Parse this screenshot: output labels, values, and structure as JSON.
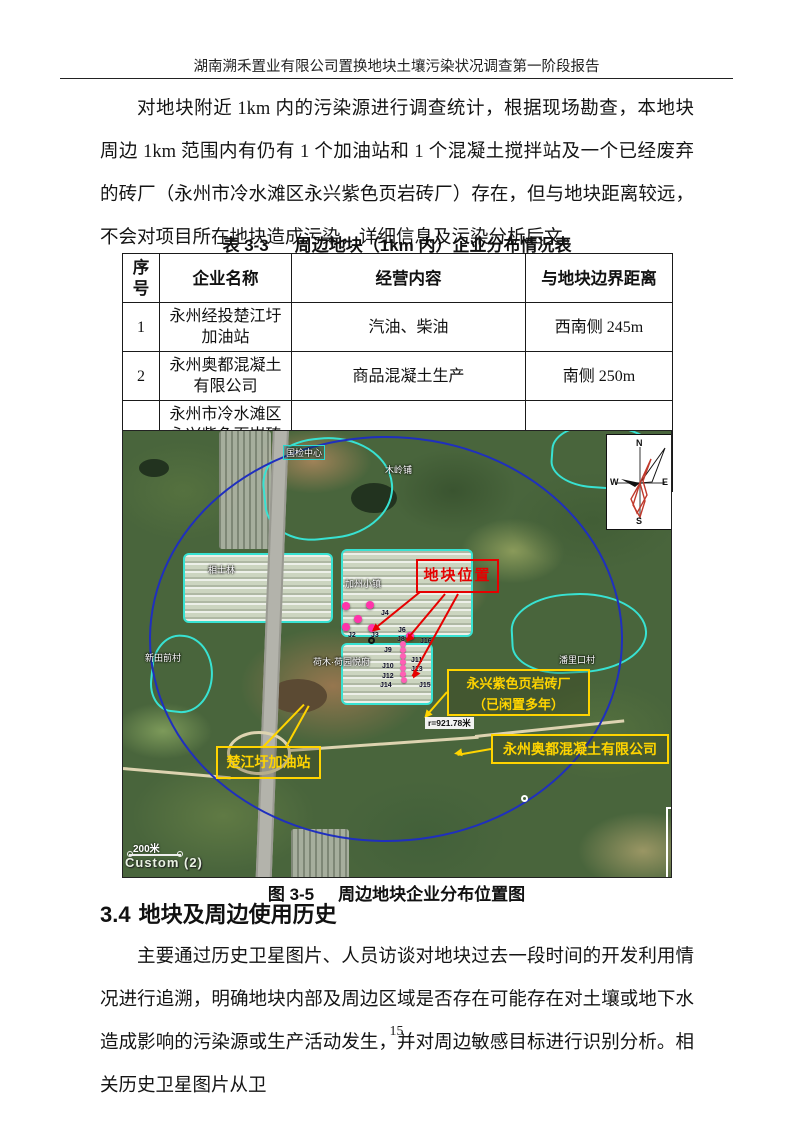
{
  "header": {
    "title": "湖南溯禾置业有限公司置换地块土壤污染状况调查第一阶段报告"
  },
  "paragraphs": {
    "p1": "对地块附近 1km 内的污染源进行调查统计，根据现场勘查，本地块周边 1km 范围内有仍有 1 个加油站和 1 个混凝土搅拌站及一个已经废弃的砖厂（永州市冷水滩区永兴紫色页岩砖厂）存在，但与地块距离较远，不会对项目所在地块造成污染，详细信息及污染分析后文。",
    "p2": "主要通过历史卫星图片、人员访谈对地块过去一段时间的开发利用情况进行追溯，明确地块内部及周边区域是否存在可能存在对土壤或地下水造成影响的污染源或生产活动发生，并对周边敏感目标进行识别分析。相关历史卫星图片从卫"
  },
  "table": {
    "label": "表 3-3",
    "title": "周边地块（1km 内）企业分布情况表",
    "columns": [
      "序号",
      "企业名称",
      "经营内容",
      "与地块边界距离"
    ],
    "rows": [
      {
        "no": "1",
        "name": "永州经投楚江圩加油站",
        "business": "汽油、柴油",
        "distance": "西南侧 245m"
      },
      {
        "no": "2",
        "name": "永州奥都混凝土有限公司",
        "business": "商品混凝土生产",
        "distance": "南侧 250m"
      },
      {
        "no": "3",
        "name": "永州市冷水滩区永兴紫色页岩砖厂（已闲置多年）",
        "business": "砖厂",
        "distance": "西南侧 140m"
      }
    ]
  },
  "map": {
    "site_label": "地块位置",
    "brick_factory_line1": "永兴紫色页岩砖厂",
    "brick_factory_line2": "（已闲置多年）",
    "concrete_label": "永州奥都混凝土有限公司",
    "gas_station_label": "楚江圩加油站",
    "radius_label": "r=921.78米",
    "scale_label": "200米",
    "source_label": "Custom (2)",
    "compass": {
      "n": "N",
      "e": "E",
      "s": "S",
      "w": "W"
    },
    "place_labels": [
      "国检中心",
      "木岭铺",
      "相士林",
      "加州小镇",
      "新田前村",
      "荷木·荷园悦府",
      "潘里口村"
    ],
    "sample_points": [
      "J4",
      "J2",
      "J3",
      "J6",
      "J8",
      "J16",
      "J9",
      "J11",
      "J10",
      "J13",
      "J12",
      "J14",
      "J15"
    ]
  },
  "figure": {
    "label": "图 3-5",
    "title": "周边地块企业分布位置图"
  },
  "section": {
    "number": "3.4",
    "title": "地块及周边使用历史"
  },
  "footer": {
    "page_number": "15"
  }
}
